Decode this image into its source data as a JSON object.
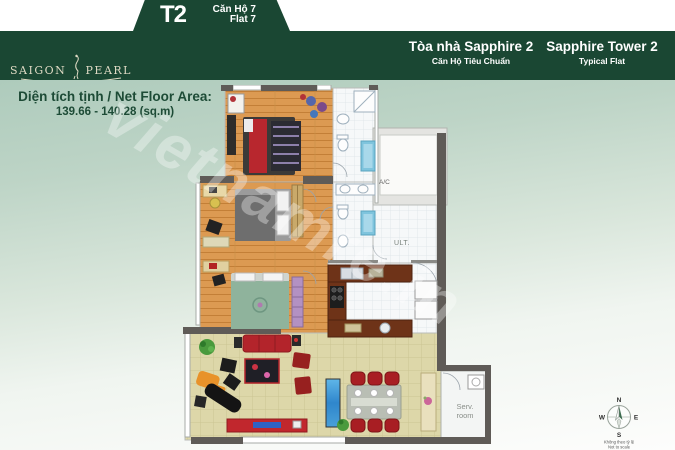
{
  "colors": {
    "brand_green": "#1a4733",
    "logo_cream": "#ddd9c3",
    "area_green": "#1d4b36",
    "bg_top": "#aecbbc",
    "bg_bottom": "#fdfdfc",
    "wood": "#dc9a52",
    "living": "#ddd7a9",
    "accent_red": "#b5242a"
  },
  "header": {
    "unit_tab": {
      "tower_code": "T2",
      "unit_vi": "Căn Hộ 7",
      "unit_en": "Flat 7"
    },
    "logo": {
      "word1": "SAIGON",
      "word2": "PEARL"
    },
    "building_vi": {
      "title": "Tòa nhà Sapphire 2",
      "subtitle": "Căn Hộ Tiêu Chuẩn"
    },
    "building_en": {
      "title": "Sapphire Tower 2",
      "subtitle": "Typical Flat"
    }
  },
  "area_info": {
    "label": "Diện tích tịnh / Net Floor Area:",
    "value": "139.66 - 140.28 (sq.m)"
  },
  "plan_labels": {
    "ac": "A/C",
    "ult": "ULT.",
    "serv_line1": "Serv.",
    "serv_line2": "room"
  },
  "compass": {
    "north": "N",
    "east": "E",
    "south": "S",
    "west": "W",
    "note_vi": "Không theo tỷ lệ",
    "note_en": "Not to scale"
  },
  "watermark": "vietnamre.in"
}
